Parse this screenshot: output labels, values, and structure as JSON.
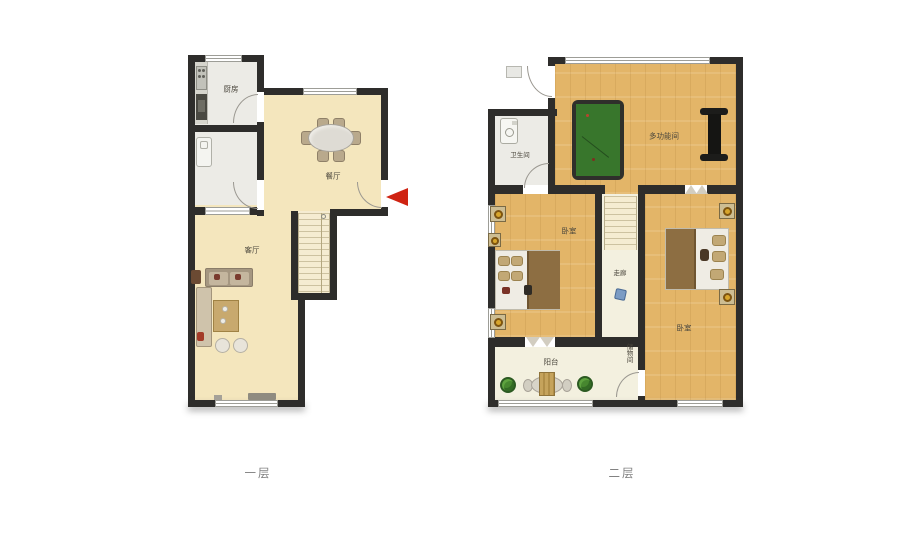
{
  "floors": {
    "floor1": {
      "label": "一层",
      "rooms": {
        "kitchen": "厨房",
        "dining": "餐厅",
        "living": "客厅"
      }
    },
    "floor2": {
      "label": "二层",
      "rooms": {
        "bathroom": "卫生间",
        "multi_room": "多功能间",
        "bedroom_left": "卧室",
        "bedroom_right": "卧室",
        "corridor": "走廊",
        "storage": "储物间",
        "balcony": "阳台"
      }
    }
  },
  "colors": {
    "wall": "#2e2d2b",
    "floor1_floor": "#f4e6bd",
    "floor2_wood": "#e3b568",
    "utility_floor": "#ecebe6",
    "pale_floor": "#f3f0df",
    "pool_table_green": "#38762c",
    "entrance_arrow_red": "#cf2312",
    "bed_blanket_brown": "#8d6e42"
  }
}
